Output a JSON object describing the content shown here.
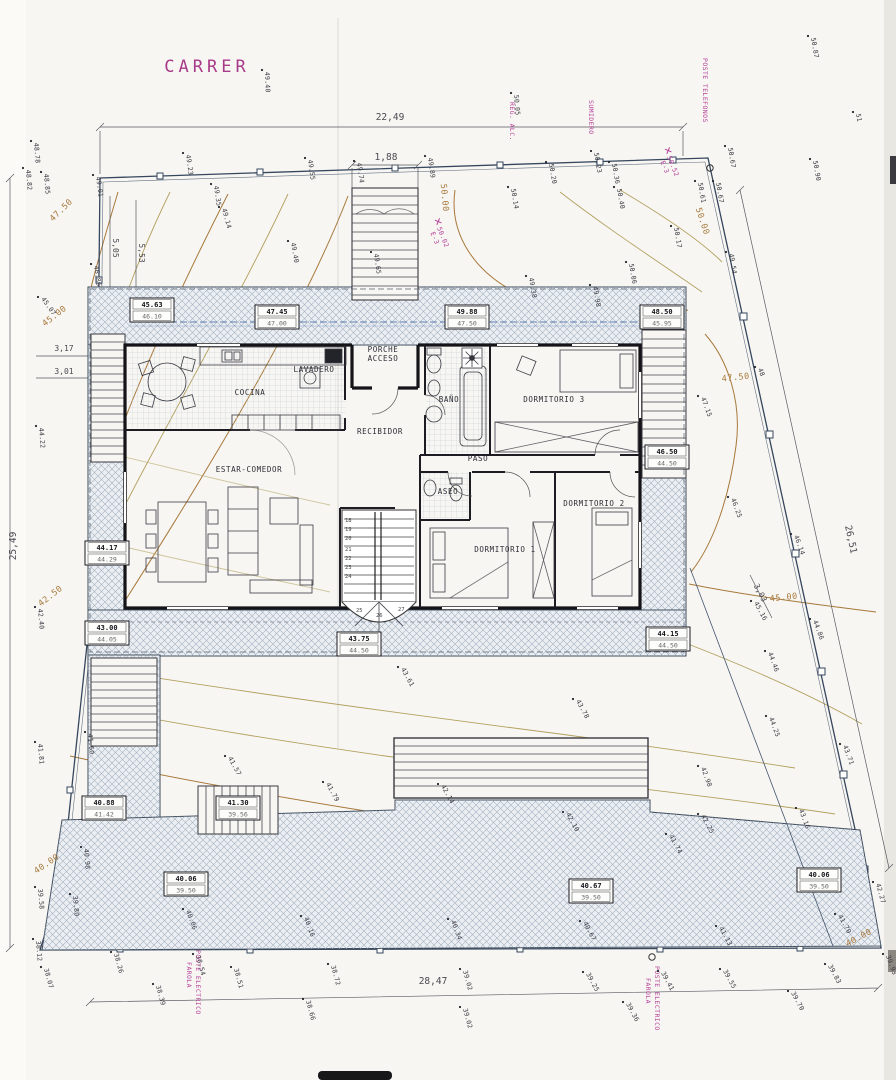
{
  "utils": {
    "street": "CARRER",
    "reg": "REG. ALC.",
    "sum": "SUMIDERO",
    "tel": "POSTE TELEFONOS",
    "elec": "POSTE ELECTRICO",
    "far": "FAROLA"
  },
  "colors": {
    "paper": "#f7f6f2",
    "ink": "#2b2b33",
    "hatch": "#9fafc0",
    "contour": "#b3a05f",
    "contour_label": "#a8793c",
    "magenta": "#b5409a",
    "boundary": "#35465e",
    "level_line_blue": "#5d7fb5"
  },
  "dims": {
    "top": "22,49",
    "entry": "1,88",
    "bottom": "28,47",
    "left": "25,49",
    "right": "26,51",
    "a": "5,05",
    "b": "5,53",
    "c": "3,17",
    "d": "3,01",
    "e": "3,03",
    "step": "17"
  },
  "bm": [
    {
      "label": "E-3",
      "value": "50.02"
    },
    {
      "label": "E-3",
      "value": "50.52"
    }
  ],
  "rooms": [
    "COCINA",
    "LAVADERO",
    "PORCHE",
    "ACCESO",
    "RECIBIDOR",
    "BAÑO",
    "PASO",
    "ASEO",
    "ESTAR-COMEDOR",
    "DORMITORIO 3",
    "DORMITORIO 2",
    "DORMITORIO 1"
  ],
  "levels": [
    {
      "a": "45.63",
      "b": "46.10"
    },
    {
      "a": "47.45",
      "b": "47.00"
    },
    {
      "a": "49.88",
      "b": "47.50"
    },
    {
      "a": "48.50",
      "b": "45.95"
    },
    {
      "a": "46.50",
      "b": "44.50"
    },
    {
      "a": "44.17",
      "b": "44.29"
    },
    {
      "a": "43.00",
      "b": "44.05"
    },
    {
      "a": "43.75",
      "b": "44.50"
    },
    {
      "a": "44.15",
      "b": "44.50"
    },
    {
      "a": "40.88",
      "b": "41.42"
    },
    {
      "a": "41.30",
      "b": "39.56"
    },
    {
      "a": "40.06",
      "b": "39.50"
    },
    {
      "a": "40.67",
      "b": "39.50"
    },
    {
      "a": "40.06",
      "b": "39.50"
    }
  ],
  "contours": [
    "47.50",
    "45.00",
    "42.50",
    "40.00",
    "50.00",
    "50.00",
    "47.50",
    "45.00",
    "40.00"
  ],
  "steps": [
    "18",
    "19",
    "20",
    "21",
    "22",
    "23",
    "24",
    "25",
    "26",
    "27"
  ],
  "pts": [
    "49.40",
    "49.40",
    "48.78",
    "48.82",
    "48.85",
    "49.01",
    "49.23",
    "49.35",
    "49.14",
    "49.55",
    "49.74",
    "49.89",
    "49.65",
    "46.86",
    "45.07",
    "50.05",
    "50.20",
    "50.23",
    "50.36",
    "50.14",
    "50.40",
    "50.17",
    "50.06",
    "49.38",
    "49.98",
    "50.61",
    "50.67",
    "50.67",
    "49.54",
    "50.87",
    "51",
    "50.90",
    "48",
    "47.15",
    "46.25",
    "46.14",
    "45.16",
    "44.86",
    "44.46",
    "44.25",
    "43.71",
    "42.98",
    "43.16",
    "42.25",
    "42.10",
    "41.74",
    "41.13",
    "41.70",
    "40.67",
    "39.25",
    "39.41",
    "39.55",
    "39.36",
    "39.83",
    "39.70",
    "39.93",
    "42.27",
    "43.61",
    "43.78",
    "42.14",
    "41.79",
    "41.57",
    "41.60",
    "41.81",
    "42.40",
    "44.22",
    "40.98",
    "39.58",
    "39.80",
    "38.12",
    "38.07",
    "38.26",
    "38.54",
    "38.51",
    "38.39",
    "38.72",
    "38.66",
    "39.02",
    "39.02",
    "40.06",
    "40.16",
    "40.34"
  ]
}
